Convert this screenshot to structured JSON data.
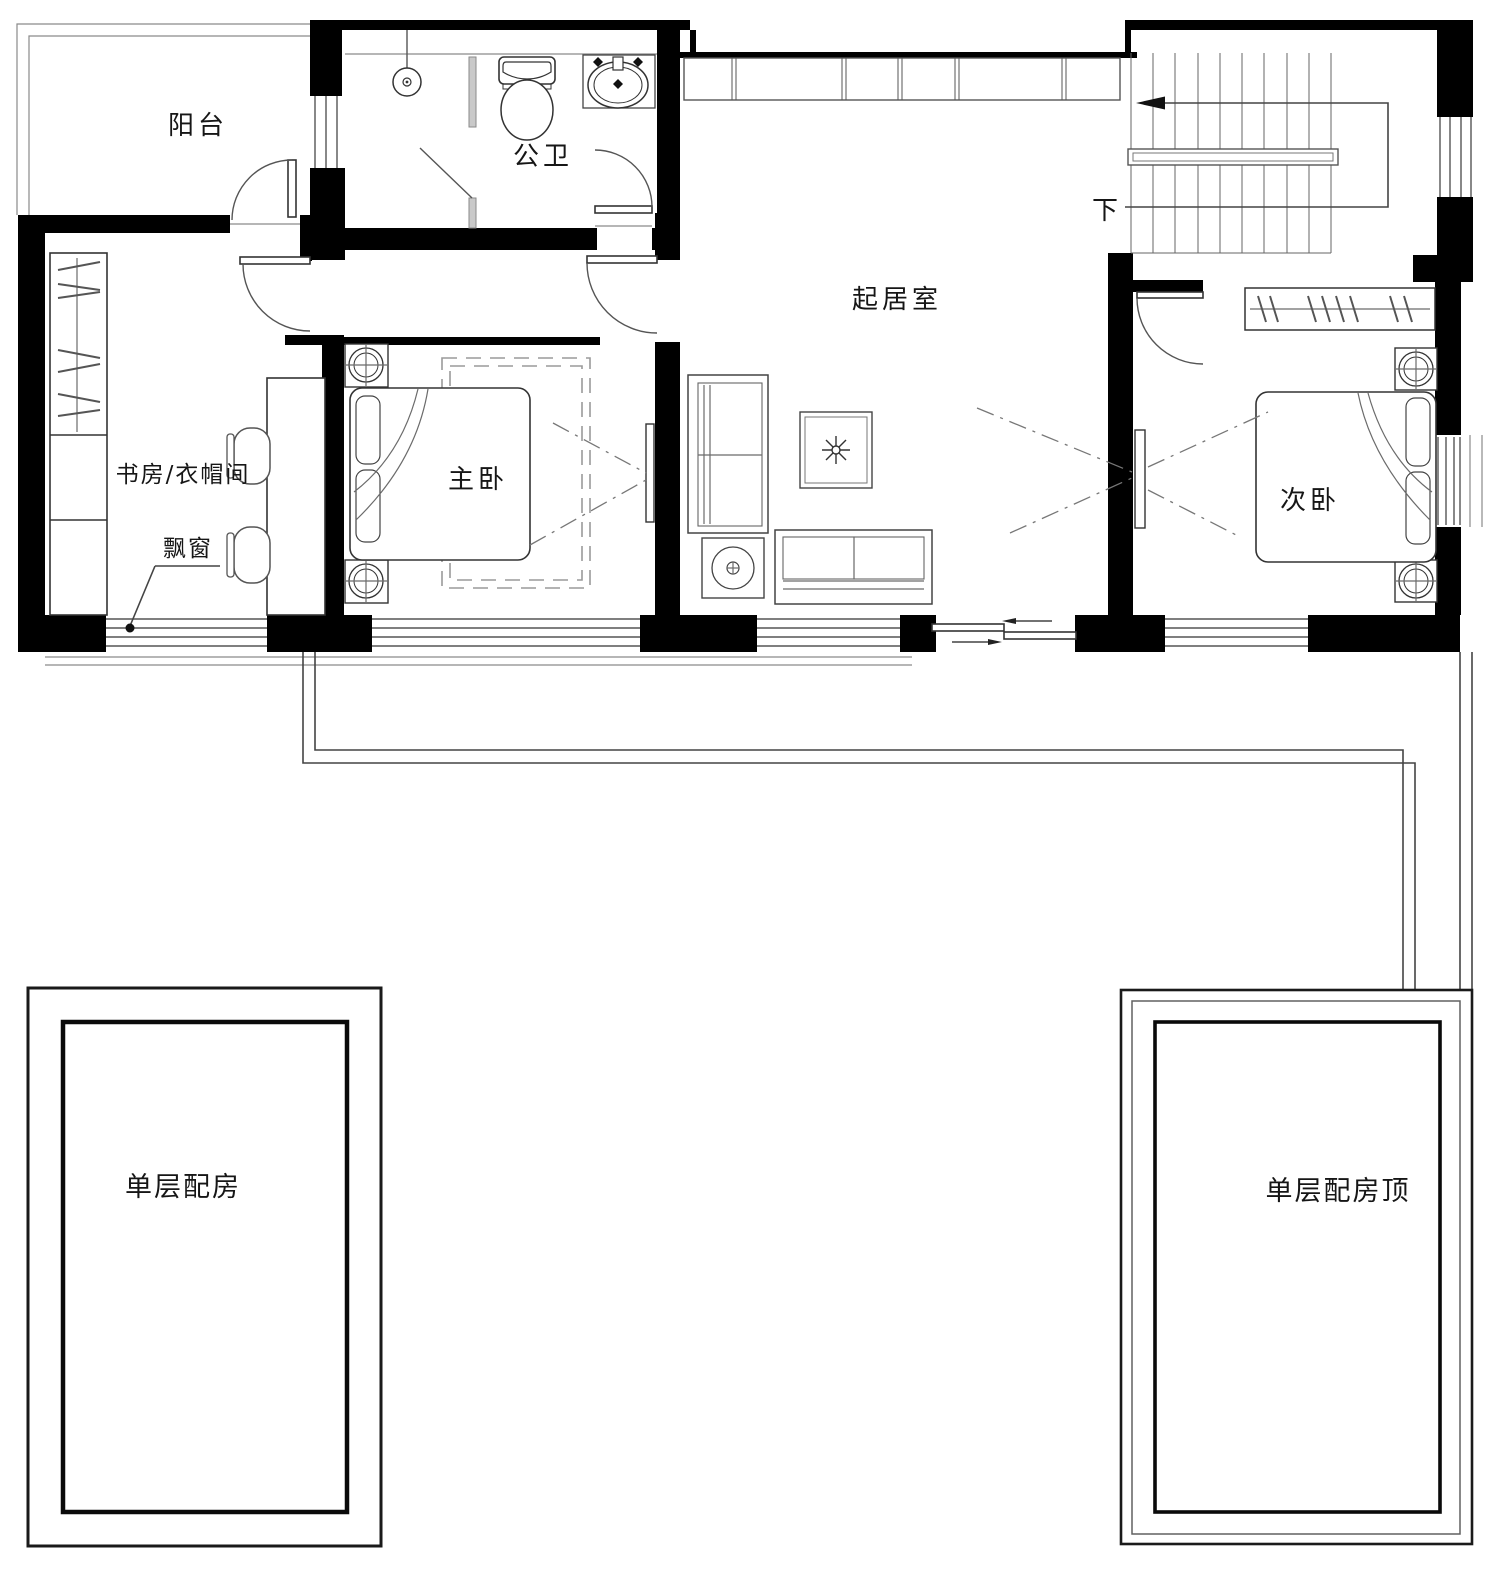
{
  "drawing": {
    "kind": "residential floor plan, second storey",
    "colors": {
      "wall": "#000000",
      "line": "#444444",
      "light_line": "#8a8a8a",
      "background": "#ffffff"
    },
    "rooms": [
      {
        "id": "balcony",
        "label": "阳台"
      },
      {
        "id": "bathroom",
        "label": "公卫"
      },
      {
        "id": "living_room",
        "label": "起居室"
      },
      {
        "id": "study_cloakroom",
        "label": "书房/衣帽间"
      },
      {
        "id": "master_bedroom",
        "label": "主卧"
      },
      {
        "id": "second_bedroom",
        "label": "次卧"
      },
      {
        "id": "annex_left",
        "label": "单层配房"
      },
      {
        "id": "annex_right",
        "label": "单层配房顶"
      }
    ]
  },
  "labels": {
    "balcony": "阳台",
    "bathroom": "公卫",
    "living_room": "起居室",
    "study_cloakroom": "书房/衣帽间",
    "bay_window": "飘窗",
    "master_bedroom": "主卧",
    "second_bedroom": "次卧",
    "stairs_down": "下",
    "annex_left": "单层配房",
    "annex_right": "单层配房顶"
  }
}
